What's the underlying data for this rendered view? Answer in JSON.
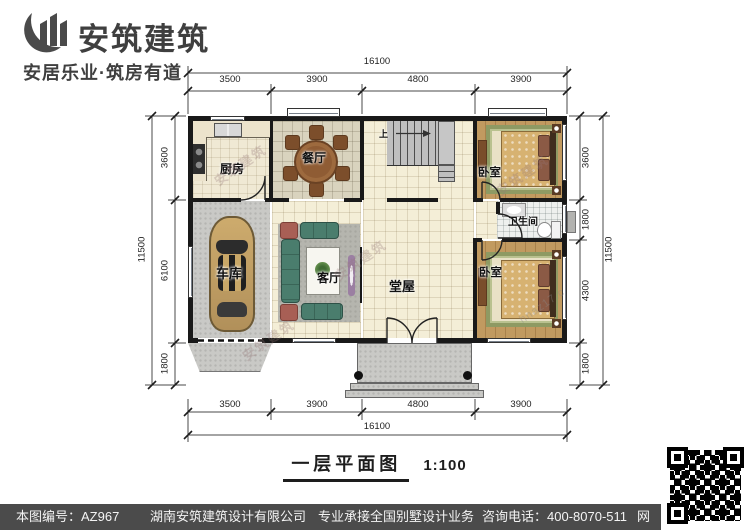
{
  "brand": {
    "name": "安筑建筑",
    "tagline": "安居乐业·筑房有道"
  },
  "plan": {
    "rooms": {
      "kitchen": "厨房",
      "dining": "餐厅",
      "garage": "车库",
      "living": "客厅",
      "hall": "堂屋",
      "bedroom_top": "卧室",
      "bedroom_bottom": "卧室",
      "bathroom": "卫生间"
    },
    "stairs_up": "上"
  },
  "dims": {
    "top_total": "16100",
    "top_segments": [
      "3500",
      "3900",
      "4800",
      "3900"
    ],
    "bottom_segments": [
      "3500",
      "3900",
      "4800",
      "3900"
    ],
    "bottom_total": "16100",
    "left_segments": [
      "3600",
      "6100",
      "1800"
    ],
    "left_total": "11500",
    "right_segments": [
      "3600",
      "1800",
      "4300",
      "1800"
    ],
    "right_total": "11500"
  },
  "title": {
    "text": "一层平面图",
    "scale": "1:100"
  },
  "footer": {
    "drawing_no": "本图编号：AZ967",
    "company": "湖南安筑建筑设计有限公司",
    "service": "专业承接全国别墅设计业务",
    "phone": "咨询电话：400-8070-511",
    "net": "网"
  },
  "watermark": {
    "brand_mark": "安筑建筑",
    "site_mark": "hnaz17.c"
  },
  "colors": {
    "wall": "#191919",
    "tile": "#f4eed7",
    "wood": "#c19a60",
    "concrete": "#c9c9c6",
    "footer_bg": "#4b4b4b",
    "logo_gray": "#4a4a4a"
  }
}
